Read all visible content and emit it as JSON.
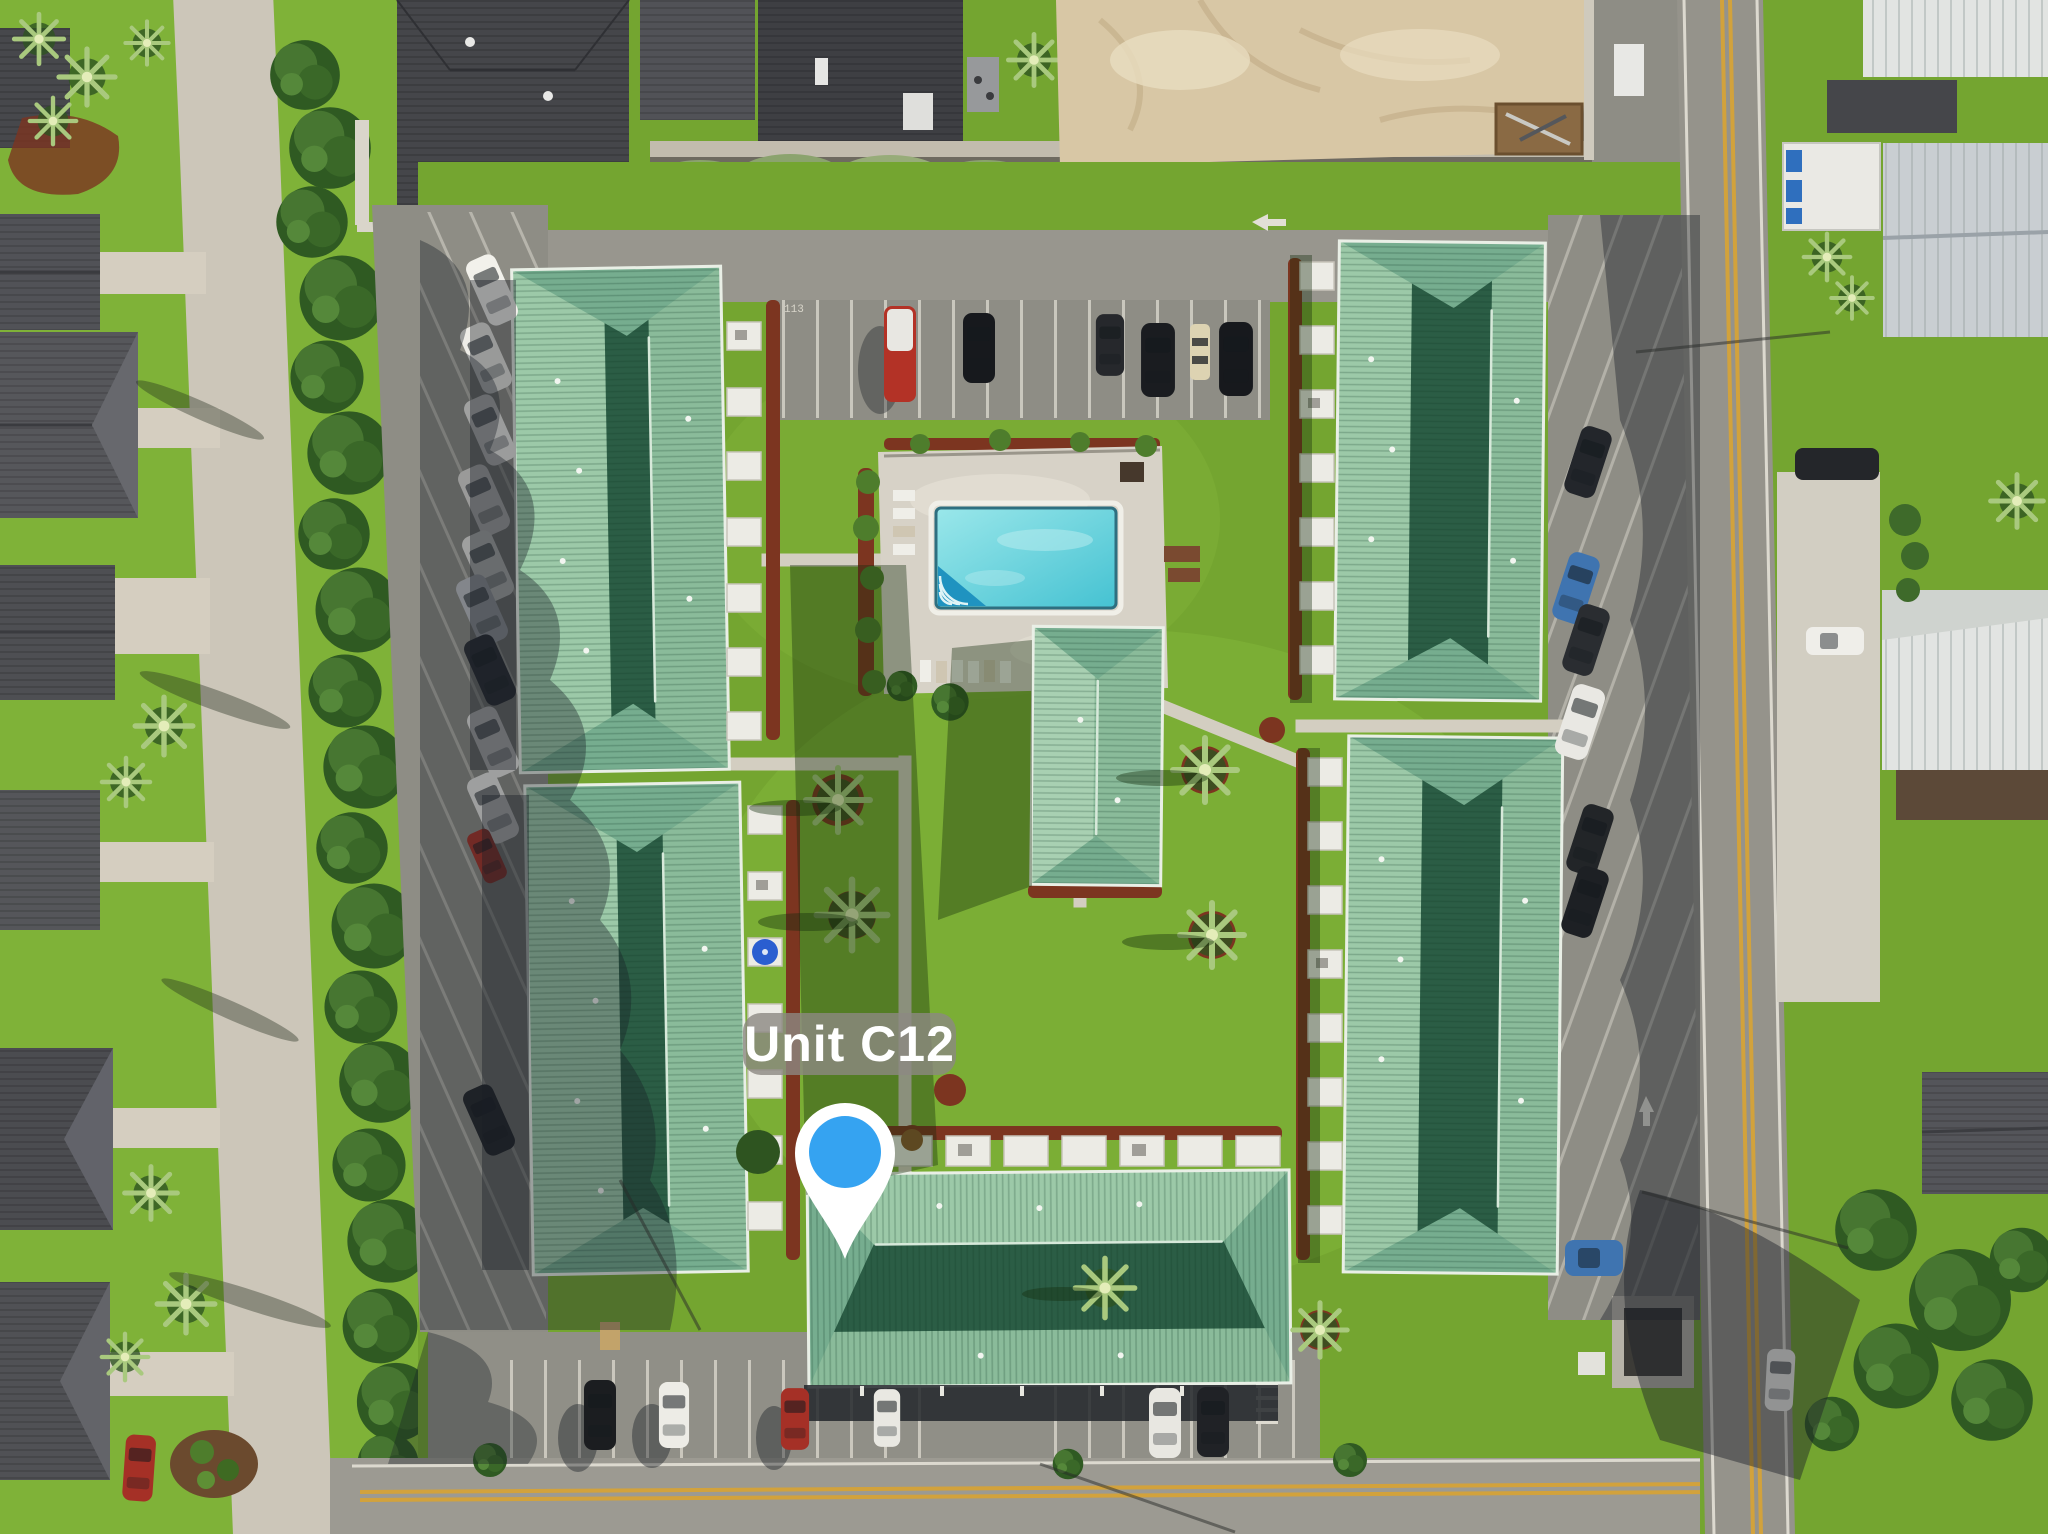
{
  "annotation": {
    "unit_label": "Unit C12"
  },
  "markings": {
    "parking_stall_number": "113"
  },
  "palette": {
    "pin_blue": "#35A3F1",
    "label_bg": "rgba(140,136,130,0.80)",
    "label_text": "#FFFFFF",
    "roof_light": "#9CC9A8",
    "roof_mid": "#8ABB9A",
    "roof_dark": "#2B5D45",
    "roof_hip": "#76AD8F",
    "roof_ridge": "#D7E9DA",
    "lawn": "#74A530",
    "lawn_bright": "#7FB238",
    "lawn_shadow": "#2F5517",
    "tree_green": "#3A6828",
    "pool_light": "#9AE7EA",
    "pool_deep": "#45C2D2",
    "pool_deck": "#D7D2C7",
    "sand": "#D8C7A5",
    "mulch": "#7C3520",
    "asphalt": "#8E8D85",
    "concrete": "#CBC5B8",
    "road_yellow": "#D2A23C",
    "dark_roof": "#47484C",
    "metal_white": "#E2E4E2"
  }
}
